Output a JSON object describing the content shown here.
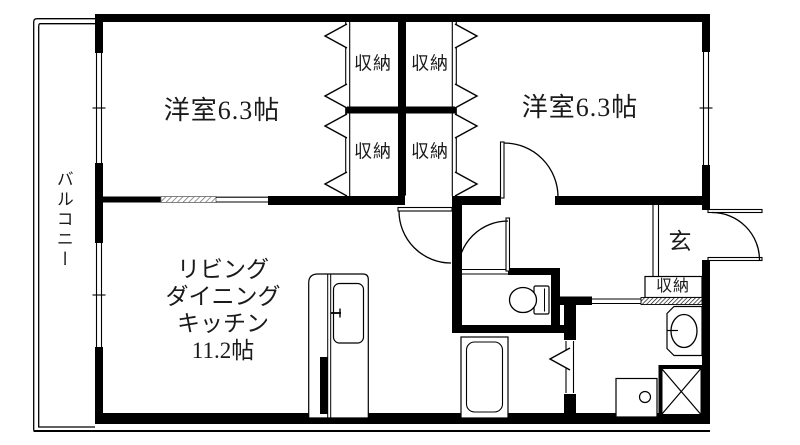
{
  "floorplan": {
    "balcony": "バルコニー",
    "bedroom_left": "洋室6.3帖",
    "bedroom_right": "洋室6.3帖",
    "ldk_lines": [
      "リビング",
      "ダイニング",
      "キッチン",
      "11.2帖"
    ],
    "closets": [
      "収納",
      "収納",
      "収納",
      "収納"
    ],
    "entrance": "玄",
    "entrance_storage": "収納",
    "colors": {
      "wall": "#000000",
      "background": "#ffffff",
      "hatch": "#777777"
    }
  }
}
